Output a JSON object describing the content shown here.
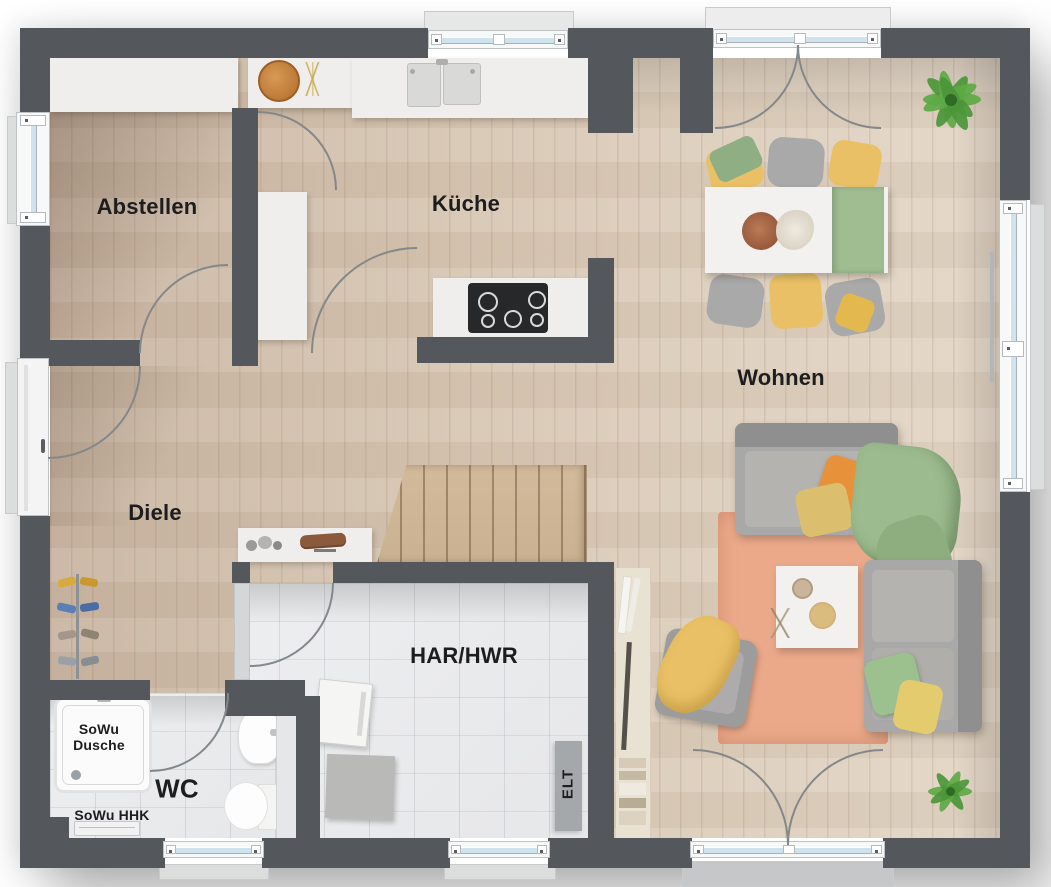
{
  "rooms": {
    "storage": {
      "label": "Abstellen"
    },
    "kitchen": {
      "label": "Küche"
    },
    "living": {
      "label": "Wohnen"
    },
    "hall": {
      "label": "Diele"
    },
    "utility": {
      "label": "HAR/HWR"
    },
    "wc": {
      "label": "WC"
    }
  },
  "annotations": {
    "shower": "SoWu\nDusche",
    "radiator": "SoWu HHK",
    "electrical": "ELT"
  },
  "colors": {
    "wall": "#54585c",
    "wood_floor": "#d8c7b4",
    "tile_floor": "#e6e7e9",
    "rug": "#eba98a",
    "window_glass": "#cfe3ef",
    "accent_yellow": "#e9c065",
    "accent_orange": "#e8913b",
    "accent_green": "#9cbb8e",
    "sofa_gray": "#a8a8a8",
    "stairs_wood": "#c9b191",
    "label_text": "#1d1d1f"
  }
}
